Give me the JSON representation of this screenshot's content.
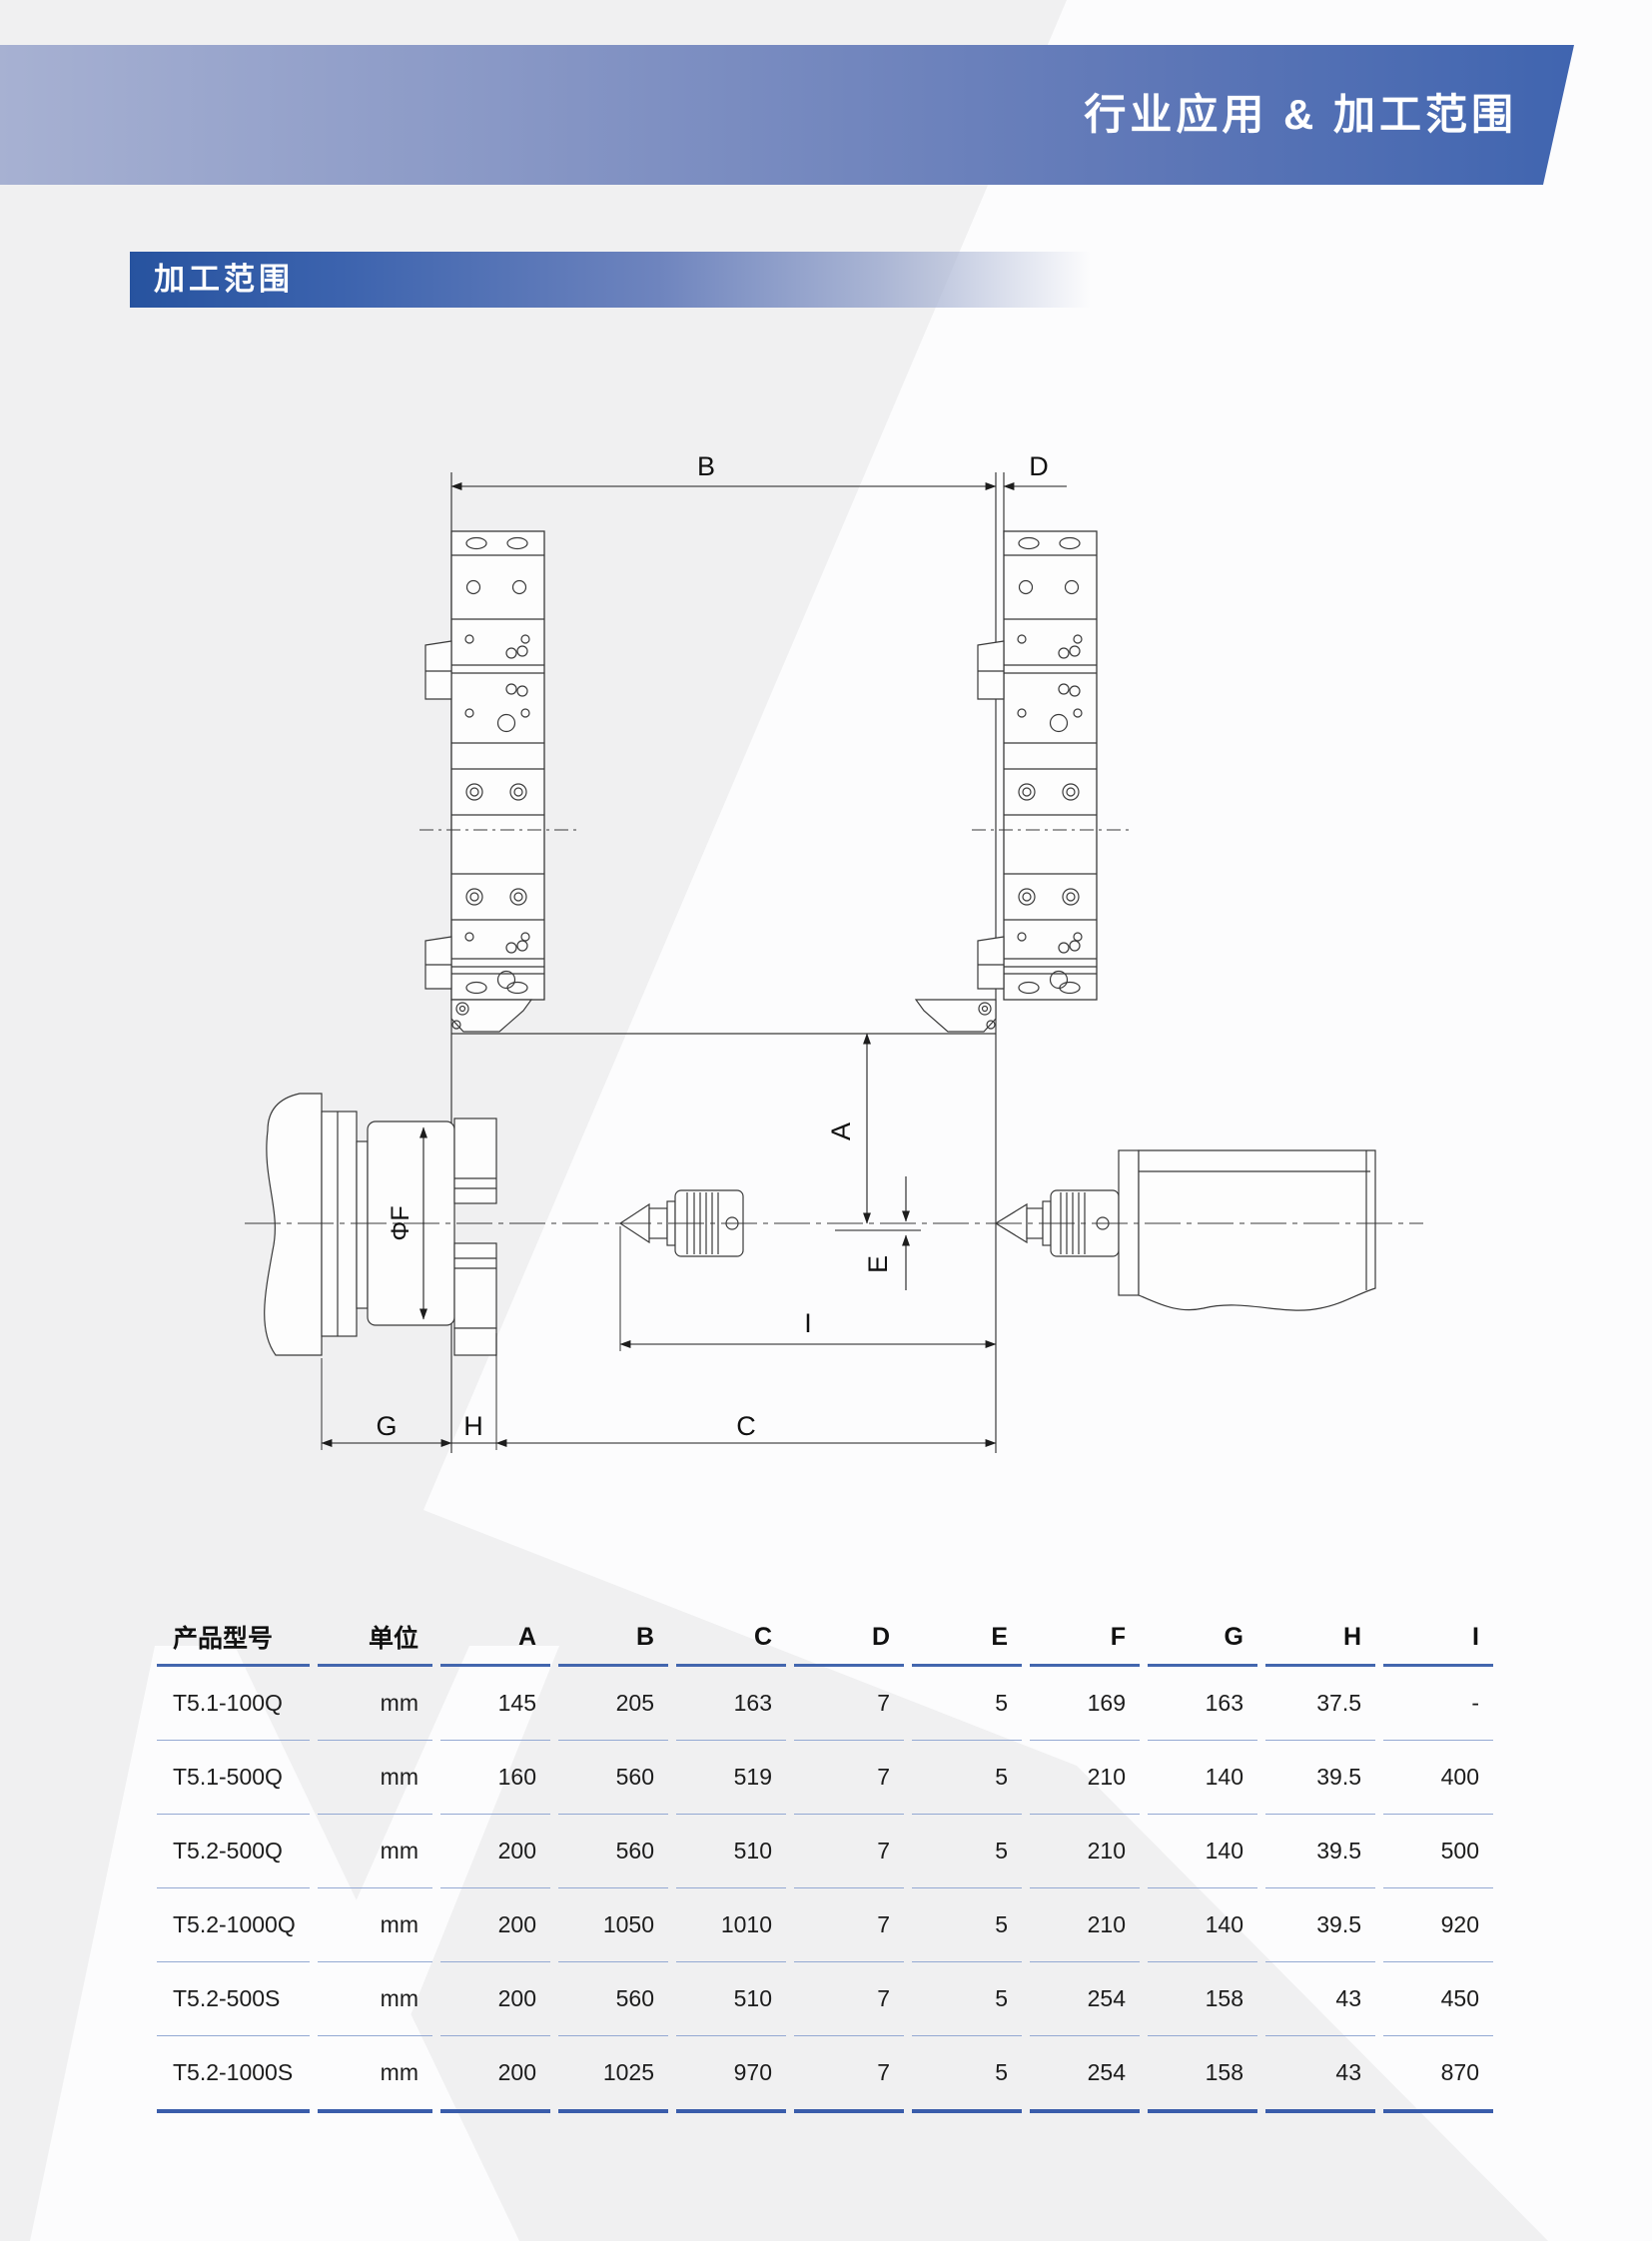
{
  "banner": {
    "title": "行业应用 & 加工范围"
  },
  "section": {
    "title": "加工范围"
  },
  "diagram": {
    "labels": {
      "A": "A",
      "B": "B",
      "C": "C",
      "D": "D",
      "E": "E",
      "F": "ΦF",
      "G": "G",
      "H": "H",
      "I": "I"
    }
  },
  "table": {
    "headers": [
      "产品型号",
      "单位",
      "A",
      "B",
      "C",
      "D",
      "E",
      "F",
      "G",
      "H",
      "I"
    ],
    "rows": [
      [
        "T5.1-100Q",
        "mm",
        "145",
        "205",
        "163",
        "7",
        "5",
        "169",
        "163",
        "37.5",
        "-"
      ],
      [
        "T5.1-500Q",
        "mm",
        "160",
        "560",
        "519",
        "7",
        "5",
        "210",
        "140",
        "39.5",
        "400"
      ],
      [
        "T5.2-500Q",
        "mm",
        "200",
        "560",
        "510",
        "7",
        "5",
        "210",
        "140",
        "39.5",
        "500"
      ],
      [
        "T5.2-1000Q",
        "mm",
        "200",
        "1050",
        "1010",
        "7",
        "5",
        "210",
        "140",
        "39.5",
        "920"
      ],
      [
        "T5.2-500S",
        "mm",
        "200",
        "560",
        "510",
        "7",
        "5",
        "254",
        "158",
        "43",
        "450"
      ],
      [
        "T5.2-1000S",
        "mm",
        "200",
        "1025",
        "970",
        "7",
        "5",
        "254",
        "158",
        "43",
        "870"
      ]
    ]
  },
  "colors": {
    "banner_left": "#a7b1d2",
    "banner_right": "#3a61ae",
    "section_bar": "#27539f",
    "table_line_thin": "#94a9d3",
    "table_line_header": "#4366ae",
    "table_line_bottom": "#3a5dab",
    "line_work": "#3a3a3a"
  }
}
